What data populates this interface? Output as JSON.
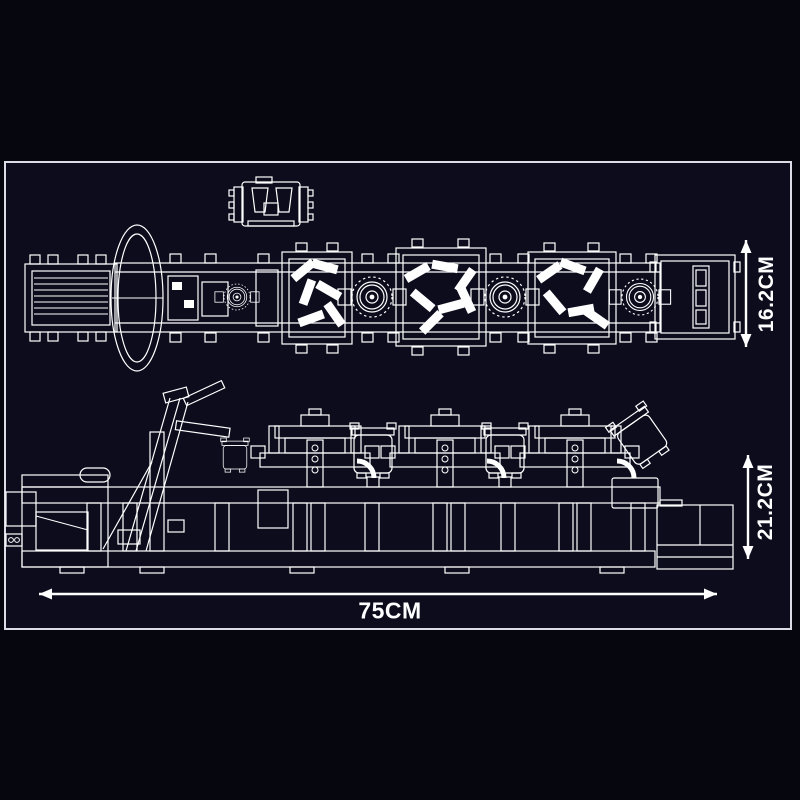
{
  "colors": {
    "canvas_bg": "#06060f",
    "panel_bg": "#0c0c1d",
    "line": "#ffffff",
    "frame_border": "#dcdce6"
  },
  "dimensions": {
    "top_view_height": {
      "label": "16.2CM",
      "value": 16.2,
      "unit": "CM",
      "orientation": "vertical"
    },
    "side_view_height": {
      "label": "21.2CM",
      "value": 21.2,
      "unit": "CM",
      "orientation": "vertical"
    },
    "overall_length": {
      "label": "75CM",
      "value": 75,
      "unit": "CM",
      "orientation": "horizontal"
    }
  }
}
